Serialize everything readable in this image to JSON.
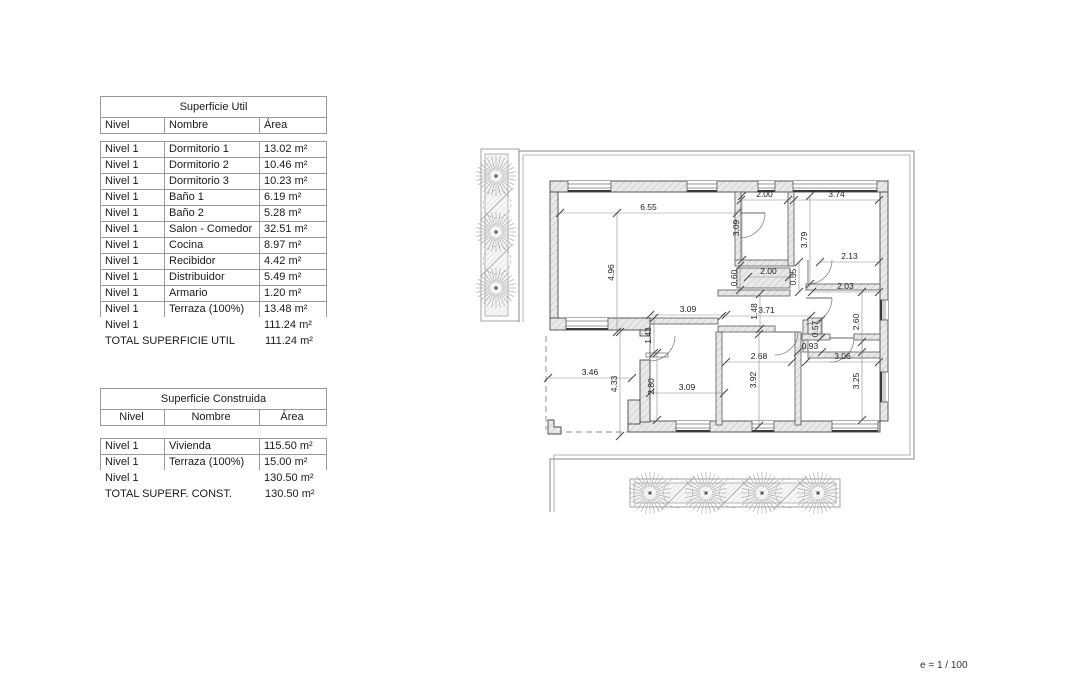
{
  "tables": {
    "util": {
      "title": "Superficie Util",
      "columns": [
        "Nivel",
        "Nombre",
        "Área"
      ],
      "rows": [
        [
          "Nivel 1",
          "Dormitorio 1",
          "13.02 m²"
        ],
        [
          "Nivel 1",
          "Dormitorio 2",
          "10.46 m²"
        ],
        [
          "Nivel 1",
          "Dormitorio 3",
          "10.23 m²"
        ],
        [
          "Nivel 1",
          "Baño 1",
          "6.19 m²"
        ],
        [
          "Nivel 1",
          "Baño 2",
          "5.28 m²"
        ],
        [
          "Nivel 1",
          "Salon - Comedor",
          "32.51 m²"
        ],
        [
          "Nivel 1",
          "Cocina",
          "8.97 m²"
        ],
        [
          "Nivel 1",
          "Recibidor",
          "4.42 m²"
        ],
        [
          "Nivel 1",
          "Distribuidor",
          "5.49 m²"
        ],
        [
          "Nivel 1",
          "Armario",
          "1.20 m²"
        ],
        [
          "Nivel 1",
          "Terraza (100%)",
          "13.48 m²"
        ]
      ],
      "subtotal": [
        "Nivel 1",
        "",
        "111.24 m²"
      ],
      "total_label": "TOTAL SUPERFICIE UTIL",
      "total_value": "111.24 m²"
    },
    "construida": {
      "title": "Superficie Construida",
      "columns": [
        "Nivel",
        "Nombre",
        "Área"
      ],
      "rows": [
        [
          "Nivel 1",
          "Vivienda",
          "115.50 m²"
        ],
        [
          "Nivel 1",
          "Terraza (100%)",
          "15.00 m²"
        ]
      ],
      "subtotal": [
        "Nivel 1",
        "",
        "130.50 m²"
      ],
      "total_label": "TOTAL SUPERF. CONST.",
      "total_value": "130.50 m²"
    }
  },
  "plan": {
    "scale_note": "e = 1 / 100",
    "dims_h": [
      {
        "l": "6.55",
        "x1": 560,
        "x2": 737,
        "y": 213
      },
      {
        "l": "2.00",
        "x1": 741,
        "x2": 788,
        "y": 200
      },
      {
        "l": "3.74",
        "x1": 794,
        "x2": 879,
        "y": 200
      },
      {
        "l": "2.13",
        "x1": 820,
        "x2": 879,
        "y": 262
      },
      {
        "l": "2.00",
        "x1": 748,
        "x2": 789,
        "y": 277
      },
      {
        "l": "2.03",
        "x1": 812,
        "x2": 879,
        "y": 292
      },
      {
        "l": "3.09",
        "x1": 650,
        "x2": 726,
        "y": 315
      },
      {
        "l": "3.71",
        "x1": 722,
        "x2": 811,
        "y": 316
      },
      {
        "l": "3.46",
        "x1": 548,
        "x2": 632,
        "y": 378
      },
      {
        "l": "3.09",
        "x1": 650,
        "x2": 724,
        "y": 393
      },
      {
        "l": "2.68",
        "x1": 726,
        "x2": 792,
        "y": 362
      },
      {
        "l": "0.93",
        "x1": 798,
        "x2": 822,
        "y": 352
      },
      {
        "l": "3.06",
        "x1": 806,
        "x2": 879,
        "y": 362
      }
    ],
    "dims_v": [
      {
        "l": "4.96",
        "x": 617,
        "y1": 213,
        "y2": 332
      },
      {
        "l": "3.09",
        "x": 742,
        "y1": 196,
        "y2": 260
      },
      {
        "l": "3.79",
        "x": 810,
        "y1": 196,
        "y2": 284
      },
      {
        "l": "0.60",
        "x": 740,
        "y1": 266,
        "y2": 290
      },
      {
        "l": "0.55",
        "x": 799,
        "y1": 262,
        "y2": 292
      },
      {
        "l": "2.60",
        "x": 862,
        "y1": 292,
        "y2": 352
      },
      {
        "l": "1.48",
        "x": 760,
        "y1": 294,
        "y2": 329
      },
      {
        "l": "1.43",
        "x": 654,
        "y1": 318,
        "y2": 353
      },
      {
        "l": "4.33",
        "x": 620,
        "y1": 332,
        "y2": 436
      },
      {
        "l": "2.80",
        "x": 657,
        "y1": 353,
        "y2": 420
      },
      {
        "l": "3.92",
        "x": 759,
        "y1": 334,
        "y2": 426
      },
      {
        "l": "0.57",
        "x": 821,
        "y1": 320,
        "y2": 338
      },
      {
        "l": "3.25",
        "x": 862,
        "y1": 342,
        "y2": 420
      }
    ],
    "walls_ext": [
      [
        550,
        181,
        338,
        11
      ],
      [
        550,
        192,
        8,
        126
      ],
      [
        880,
        192,
        8,
        229
      ],
      [
        628,
        421,
        252,
        11
      ],
      [
        550,
        318,
        100,
        12
      ],
      [
        640,
        330,
        10,
        6
      ],
      [
        640,
        360,
        10,
        62
      ],
      [
        628,
        400,
        12,
        24
      ]
    ],
    "walls_int": [
      [
        735,
        192,
        6,
        70
      ],
      [
        735,
        260,
        59,
        6
      ],
      [
        788,
        192,
        6,
        74
      ],
      [
        806,
        284,
        74,
        6
      ],
      [
        718,
        290,
        72,
        6
      ],
      [
        803,
        320,
        5,
        32
      ],
      [
        808,
        352,
        72,
        6
      ],
      [
        718,
        326,
        57,
        6
      ],
      [
        716,
        332,
        6,
        93
      ],
      [
        795,
        332,
        6,
        93
      ],
      [
        802,
        334,
        28,
        6
      ],
      [
        854,
        334,
        26,
        6
      ],
      [
        650,
        318,
        68,
        6
      ],
      [
        808,
        318,
        14,
        16
      ],
      [
        737,
        268,
        53,
        20
      ]
    ],
    "windows": [
      {
        "x": 568,
        "y": 181,
        "w": 43,
        "h": 11,
        "o": "h"
      },
      {
        "x": 687,
        "y": 181,
        "w": 30,
        "h": 11,
        "o": "h"
      },
      {
        "x": 758,
        "y": 181,
        "w": 17,
        "h": 11,
        "o": "h"
      },
      {
        "x": 793,
        "y": 181,
        "w": 84,
        "h": 11,
        "o": "h"
      },
      {
        "x": 566,
        "y": 318,
        "w": 42,
        "h": 12,
        "o": "h"
      },
      {
        "x": 676,
        "y": 421,
        "w": 34,
        "h": 11,
        "o": "h"
      },
      {
        "x": 752,
        "y": 421,
        "w": 22,
        "h": 11,
        "o": "h"
      },
      {
        "x": 832,
        "y": 421,
        "w": 46,
        "h": 11,
        "o": "h"
      },
      {
        "x": 880,
        "y": 300,
        "w": 8,
        "h": 20,
        "o": "v"
      },
      {
        "x": 880,
        "y": 372,
        "w": 8,
        "h": 30,
        "o": "v"
      }
    ],
    "doors": [
      {
        "cx": 650,
        "cy": 336,
        "r": 25,
        "a1": 90,
        "a2": 0
      },
      {
        "cx": 740,
        "cy": 213,
        "r": 25,
        "a1": 0,
        "a2": 90
      },
      {
        "cx": 808,
        "cy": 260,
        "r": 24,
        "a1": 90,
        "a2": 0
      },
      {
        "cx": 806,
        "cy": 298,
        "r": 26,
        "a1": 0,
        "a2": 90
      },
      {
        "cx": 775,
        "cy": 332,
        "r": 23,
        "a1": 0,
        "a2": 90
      },
      {
        "cx": 830,
        "cy": 338,
        "r": 24,
        "a1": 0,
        "a2": 90
      }
    ],
    "dashed": [
      [
        546,
        336,
        546,
        430
      ],
      [
        556,
        432,
        628,
        432
      ]
    ],
    "lpiece": "548,420 554,420 554,427 561,427 561,434 548,434",
    "threshold": [
      646,
      353,
      22,
      4
    ],
    "boundary_outer": "M519,322 L519,151 L914,151 L914,459 L550,459 L550,512",
    "boundary_inner": "M523,322 L523,155 L910,155 L910,455 L554,455 L554,512",
    "planters": [
      {
        "box": [
          481,
          149,
          38,
          172
        ],
        "bed": [
          485,
          154,
          23,
          162
        ],
        "r": 20,
        "trees": [
          [
            496,
            176
          ],
          [
            496,
            232
          ],
          [
            496,
            288
          ]
        ],
        "bushes": [
          [
            497,
            204
          ],
          [
            497,
            260
          ]
        ]
      },
      {
        "box": [
          630,
          479,
          210,
          28
        ],
        "bed": [
          634,
          483,
          202,
          20
        ],
        "r": 21,
        "trees": [
          [
            650,
            493
          ],
          [
            706,
            493
          ],
          [
            762,
            493
          ],
          [
            818,
            493
          ]
        ],
        "bushes": [
          [
            678,
            493
          ],
          [
            734,
            493
          ],
          [
            790,
            493
          ]
        ]
      }
    ]
  }
}
